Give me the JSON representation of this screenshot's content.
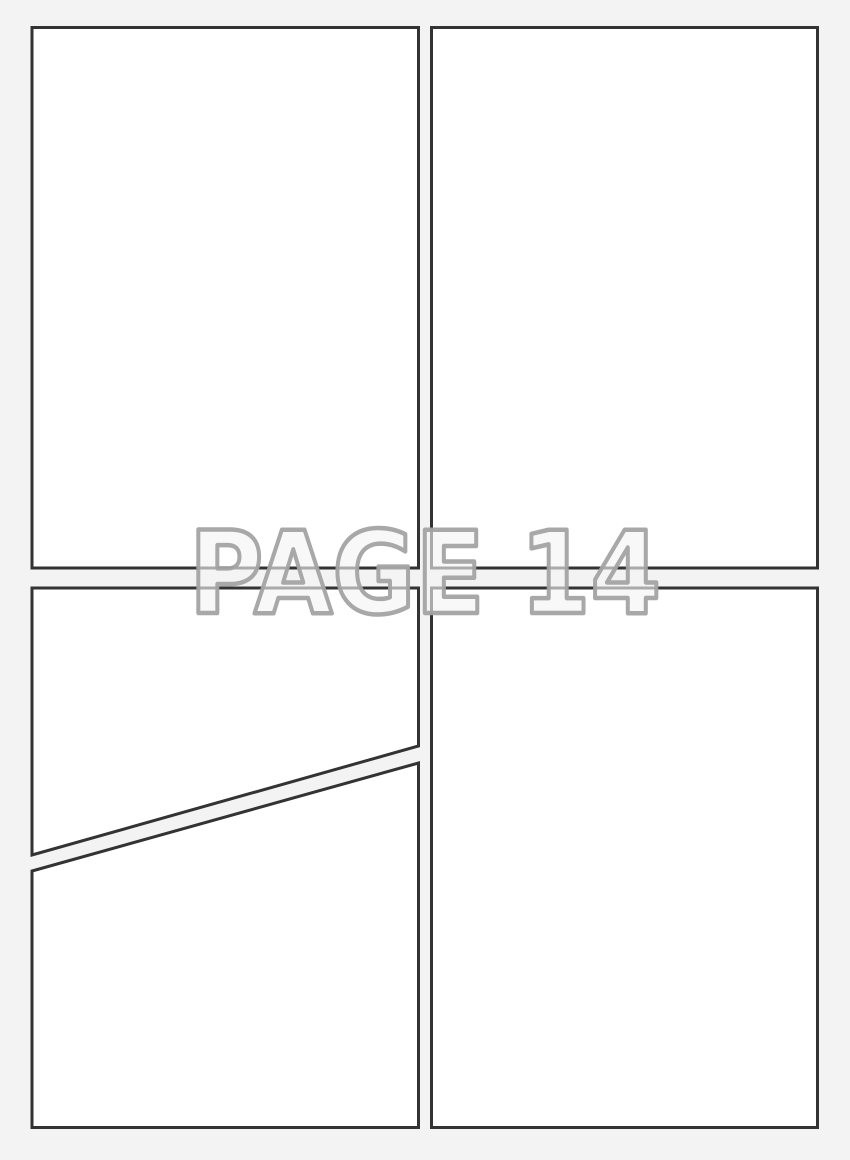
{
  "page": {
    "title": "PAGE 14",
    "colors": {
      "background": "#f3f3f3",
      "panel_fill": "#ffffff",
      "panel_border": "#333333",
      "title_fill": "#f3f3f3",
      "title_outline": "#a3a3a3"
    },
    "panels": [
      {
        "name": "top-left"
      },
      {
        "name": "top-right"
      },
      {
        "name": "bottom-left-upper"
      },
      {
        "name": "bottom-left-lower"
      },
      {
        "name": "bottom-right"
      }
    ]
  }
}
